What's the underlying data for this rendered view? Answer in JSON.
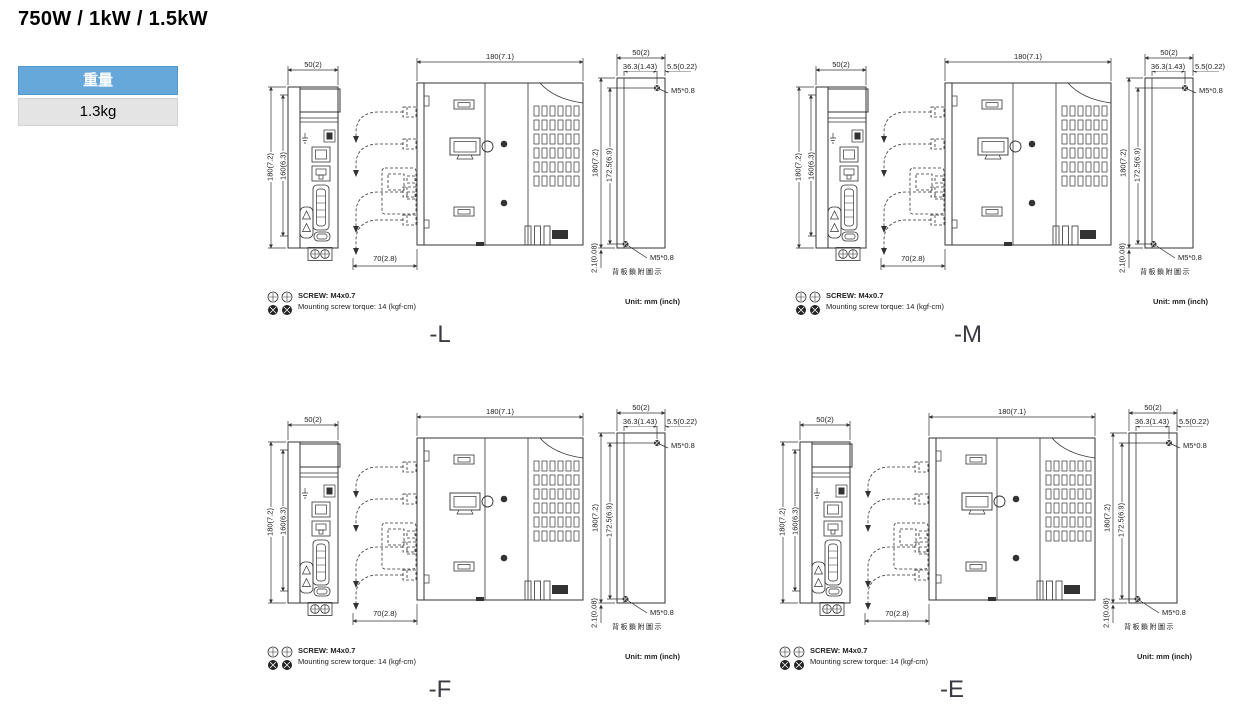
{
  "page": {
    "title": "750W / 1kW / 1.5kW"
  },
  "weight_table": {
    "header": "重量",
    "value": "1.3kg"
  },
  "notes": {
    "screw": "SCREW: M4x0.7",
    "torque": "Mounting screw torque: 14 (kgf-cm)",
    "unit": "Unit: mm (inch)"
  },
  "dims": {
    "front_width": "50(2)",
    "front_height_outer": "180(7.2)",
    "front_height_inner": "160(6.3)",
    "side_width": "180(7.1)",
    "cable_clearance": "70(2.8)",
    "rear_width": "50(2)",
    "rear_hole_span": "36.3(1.43)",
    "rear_edge_offset": "5.5(0.22)",
    "rear_height_outer": "180(7.2)",
    "rear_hole_height": "172.5(6.9)",
    "rear_bottom_offset": "2.1(0.08)",
    "screw_spec": "M5*0.8",
    "rear_caption": "背板鎖附圖示"
  },
  "variants": [
    {
      "label": "-L"
    },
    {
      "label": "-M"
    },
    {
      "label": "-F"
    },
    {
      "label": "-E"
    }
  ],
  "icons": [
    {
      "name": "screw-head-top-icon",
      "meaning": "machine screw head (top view)"
    },
    {
      "name": "screw-head-side-icon",
      "meaning": "machine screw head (filled view)"
    }
  ],
  "colors": {
    "accent_blue": "#67a8da",
    "table_value_bg": "#e4e4e4",
    "line_color": "#333333",
    "label_color": "#3a3a42"
  }
}
